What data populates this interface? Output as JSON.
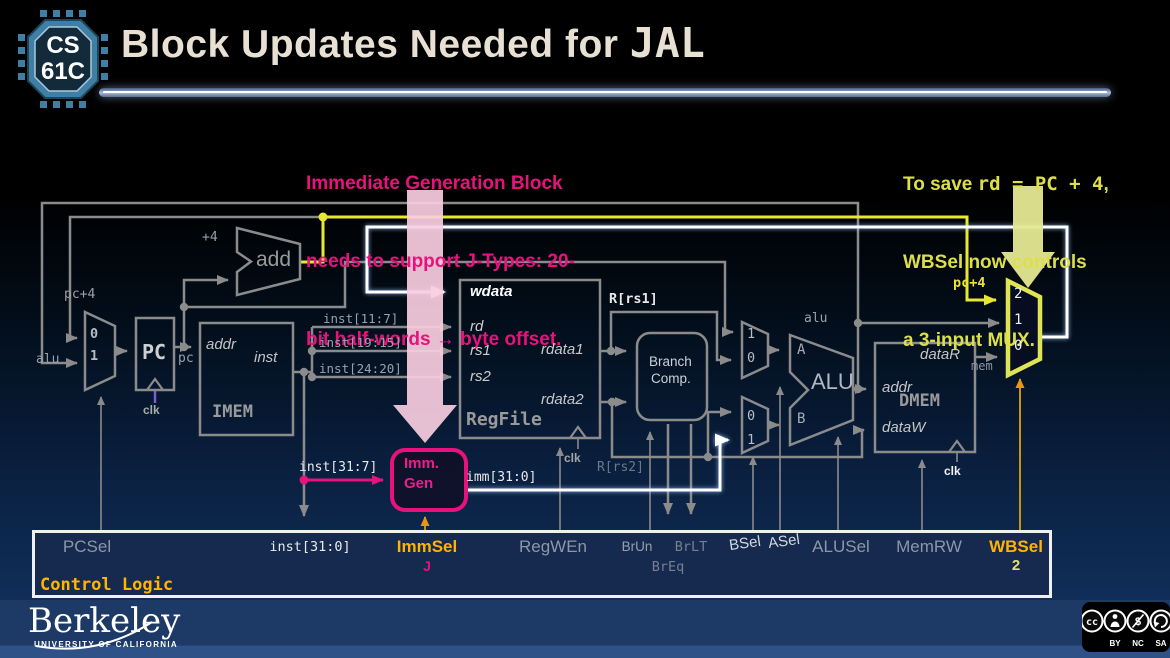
{
  "header": {
    "logo_line1": "CS",
    "logo_line2": "61C",
    "title_text": "Block Updates Needed for ",
    "title_code": "JAL"
  },
  "notes": {
    "pink": [
      "Immediate Generation Block",
      "needs to support J-Types: 20-",
      "bit half-words → byte offset."
    ],
    "yellow_pre": "To save ",
    "yellow_code": "rd = PC + 4",
    "yellow_post": ",",
    "yellow_line2": "WBSel now controls",
    "yellow_line3": "a 3-input MUX."
  },
  "datapath": {
    "pc_mux": [
      "0",
      "1"
    ],
    "a_mux": [
      "1",
      "0"
    ],
    "b_mux": [
      "0",
      "1"
    ],
    "wb_mux": [
      "2",
      "1",
      "0"
    ],
    "labels": {
      "plus4": "+4",
      "add": "add",
      "pc_plus4": "pc+4",
      "alu_in": "alu",
      "pc_block": "PC",
      "pc_out": "pc",
      "clk": "clk",
      "imem": "IMEM",
      "imem_addr": "addr",
      "imem_inst": "inst",
      "slice_11_7": "inst[11:7]",
      "slice_19_15": "inst[19:15]",
      "slice_24_20": "inst[24:20]",
      "inst_31_7": "inst[31:7]",
      "immgen_line1": "Imm.",
      "immgen_line2": "Gen",
      "imm_31_0": "imm[31:0]",
      "regfile": "RegFile",
      "wdata": "wdata",
      "rd": "rd",
      "rs1": "rs1",
      "rs2": "rs2",
      "rdata1": "rdata1",
      "rdata2": "rdata2",
      "r_rs1": "R[rs1]",
      "r_rs2": "R[rs2]",
      "branch_line1": "Branch",
      "branch_line2": "Comp.",
      "alu_block": "ALU",
      "alu_a": "A",
      "alu_b": "B",
      "alu_out": "alu",
      "dmem": "DMEM",
      "dataR": "dataR",
      "dmem_addr": "addr",
      "dataW": "dataW",
      "mem": "mem",
      "pc_plus4_wb": "pc+4"
    }
  },
  "control": {
    "title": "Control Logic",
    "pcsel": "PCSel",
    "inst_31_0": "inst[31:0]",
    "immsel": "ImmSel",
    "immsel_value": "J",
    "regwen": "RegWEn",
    "brun": "BrUn",
    "breq": "BrEq",
    "brlt": "BrLT",
    "bsel": "BSel",
    "asel": "ASel",
    "alusel": "ALUSel",
    "memrw": "MemRW",
    "wbsel": "WBSel",
    "wbsel_value": "2"
  },
  "footer": {
    "wordmark": "Berkeley",
    "subtitle": "UNIVERSITY OF CALIFORNIA",
    "license": [
      "BY",
      "NC",
      "SA"
    ]
  },
  "colors": {
    "magenta_accent": "#e8127c",
    "gold_accent": "#ffb404",
    "yellow_wire": "#e8e832",
    "mux_yellow": "#dfe356",
    "pink_arrow": "#f8cde0",
    "wire_gray": "#8b8b8b",
    "berkeley_navy": "#1d3a66",
    "logo_blue": "#3f7fa5"
  }
}
